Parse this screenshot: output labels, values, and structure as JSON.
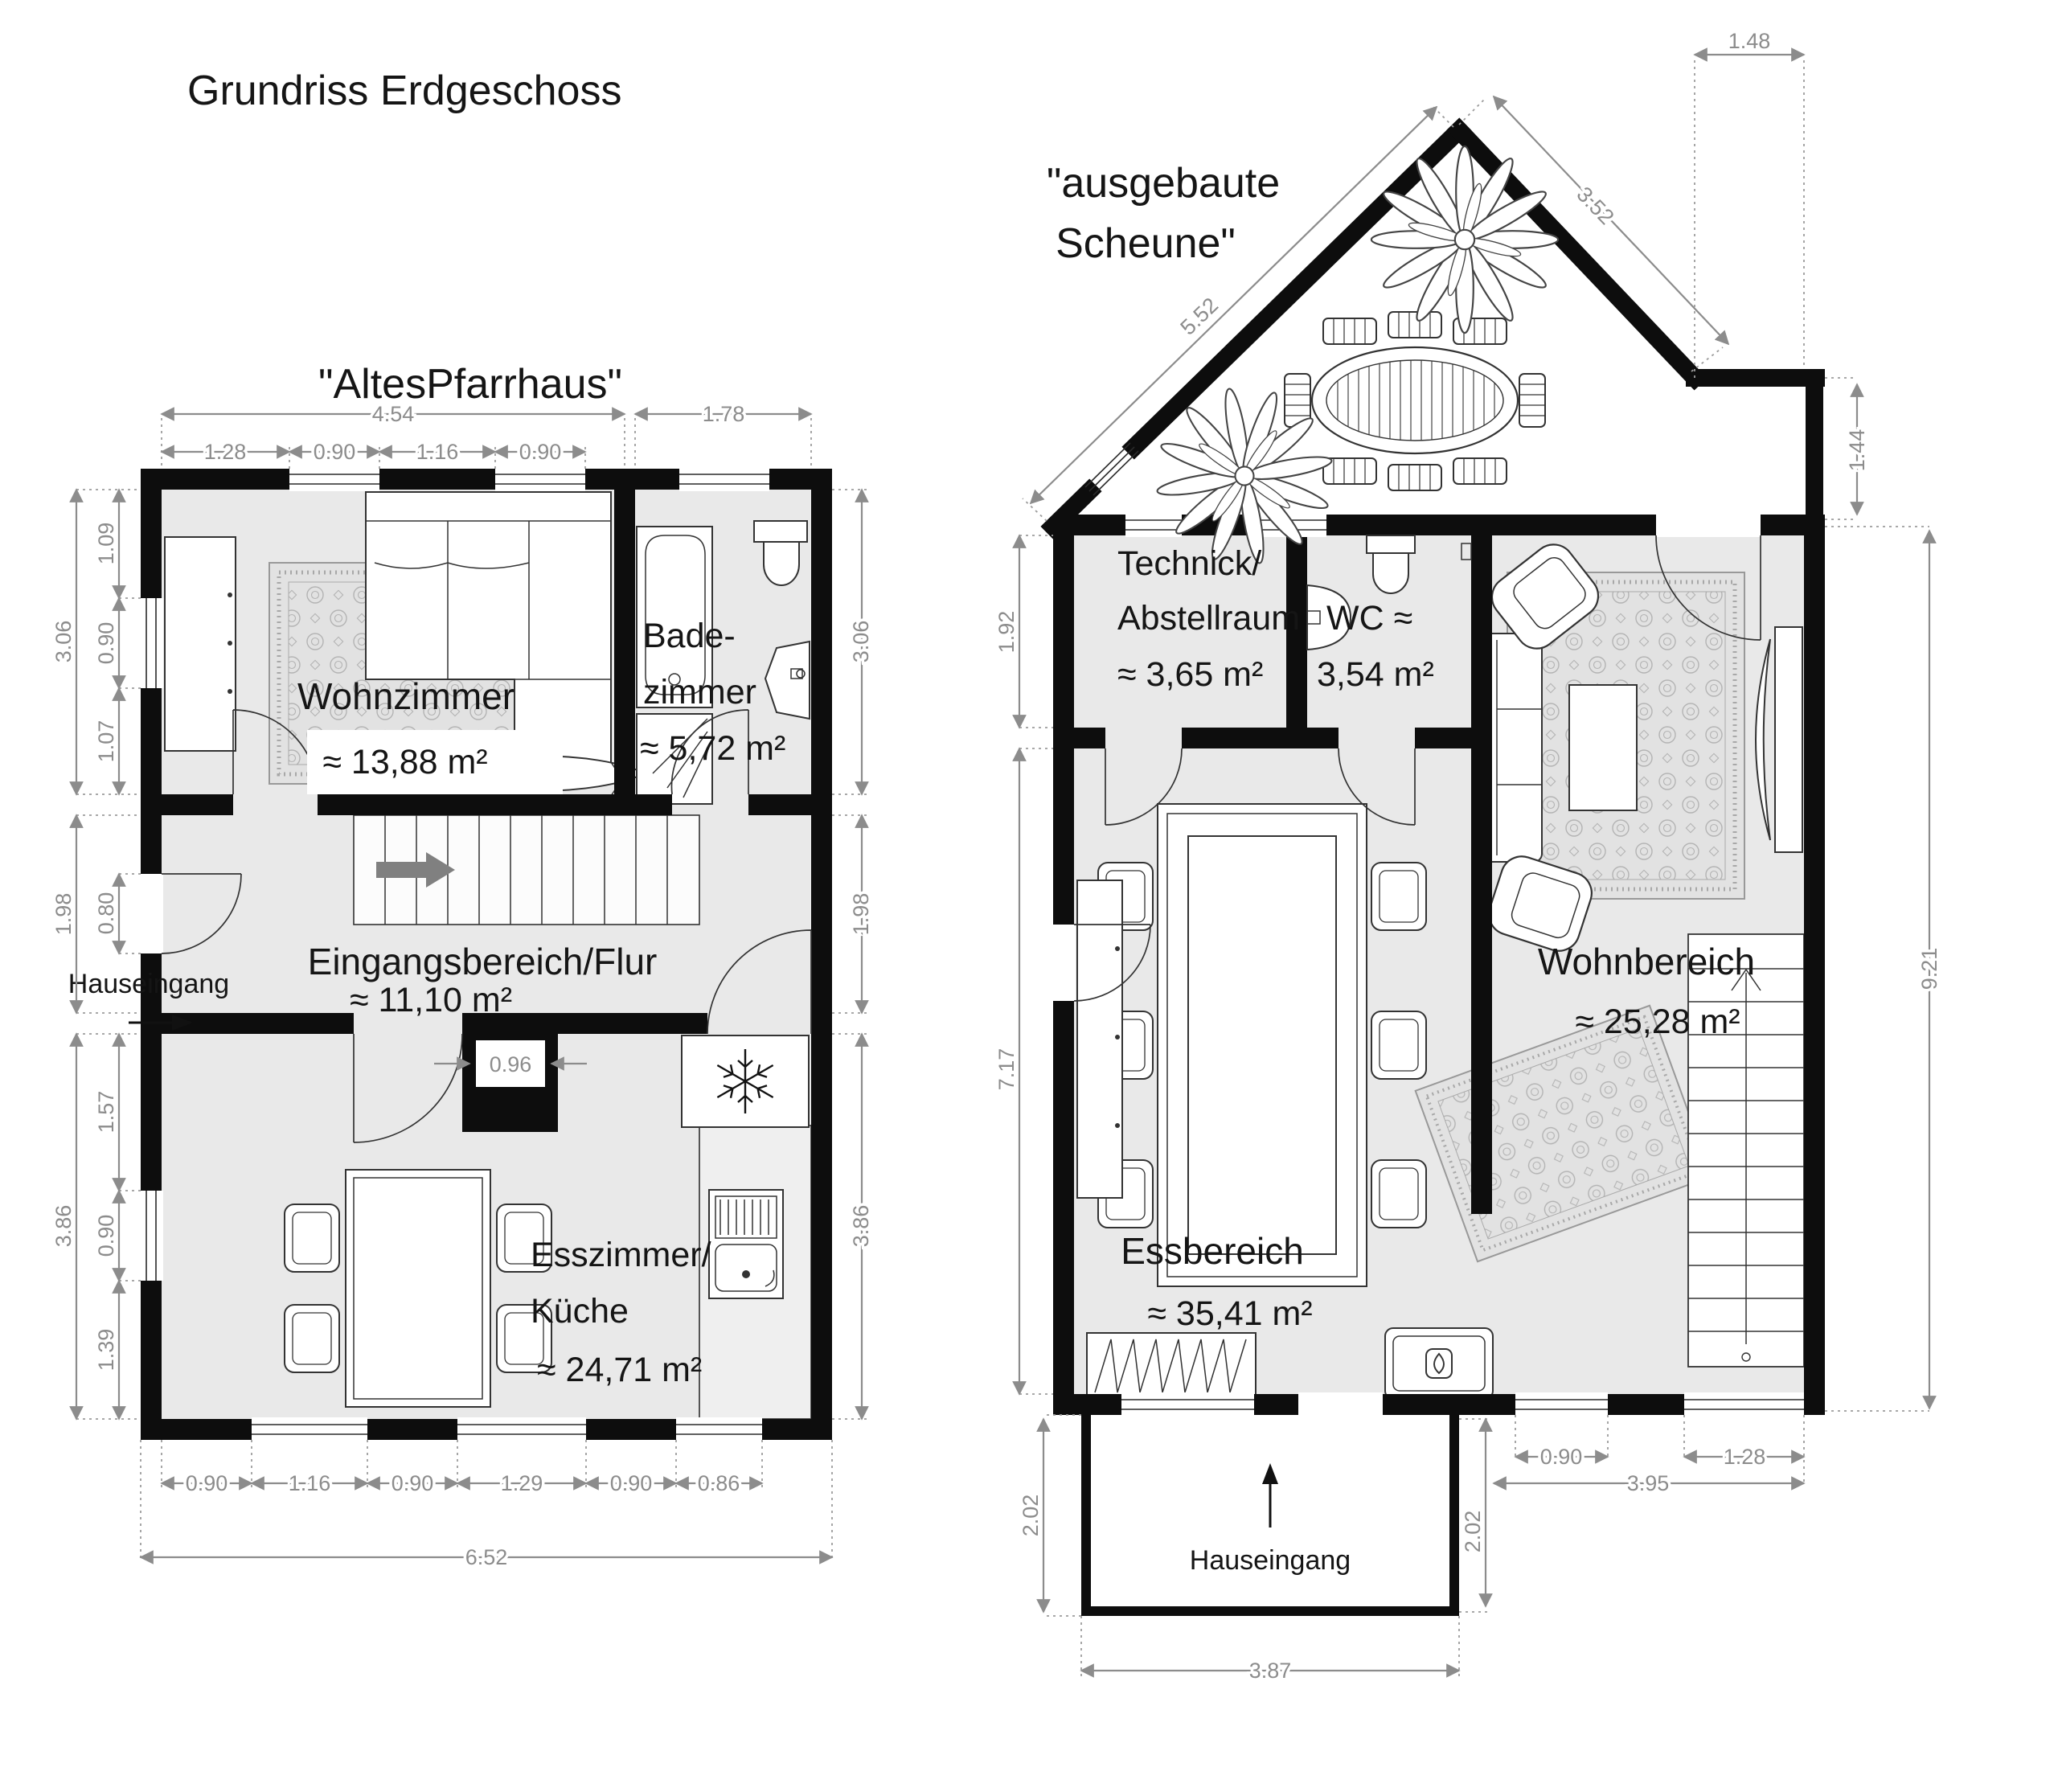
{
  "title": "Grundriss Erdgeschoss",
  "left_plan": {
    "name": "\"AltesPfarrhaus\"",
    "entrance": "Hauseingang",
    "rooms": {
      "wohnzimmer": {
        "label": "Wohnzimmer",
        "area": "≈ 13,88 m²"
      },
      "badezimmer": {
        "label1": "Bade-",
        "label2": "zimmer",
        "area": "≈ 5,72 m²"
      },
      "flur": {
        "label": "Eingangsbereich/Flur",
        "area": "≈ 11,10 m²"
      },
      "esszimmer": {
        "label1": "Esszimmer/",
        "label2": "Küche",
        "area": "≈ 24,71 m²"
      }
    },
    "dims": {
      "top_main": "4.54",
      "top_bath": "1.78",
      "top_sub": [
        "1.28",
        "0.90",
        "1.16",
        "0.90"
      ],
      "left_outer": [
        "3.06",
        "1.98",
        "3.86"
      ],
      "left_inner": [
        "1.09",
        "0.90",
        "1.07",
        "0.80",
        "1.57",
        "0.90",
        "1.39"
      ],
      "right_side": [
        "3.06",
        "1.98",
        "3.86"
      ],
      "bottom_sub": [
        "0.90",
        "1.16",
        "0.90",
        "1.29",
        "0.90",
        "0.86"
      ],
      "bottom_total": "6.52",
      "passage": "0.96"
    }
  },
  "right_plan": {
    "name_line1": "\"ausgebaute",
    "name_line2": "Scheune\"",
    "entrance": "Hauseingang",
    "rooms": {
      "technik": {
        "label1": "Technick/",
        "label2": "Abstellraum",
        "area": "≈ 3,65 m²"
      },
      "wc": {
        "label1": "WC ≈",
        "area": "3,54 m²"
      },
      "wohnbereich": {
        "label": "Wohnbereich",
        "area": "≈ 25,28 m²"
      },
      "essbereich": {
        "label": "Essbereich",
        "area": "≈ 35,41 m²"
      }
    },
    "dims": {
      "roof_left": "5.52",
      "roof_right": "3.52",
      "top_right": "1.48",
      "right_step": "1.44",
      "left_top": "1.92",
      "left_main": "7.17",
      "right_total": "9.21",
      "bottom_win1": "0.90",
      "bottom_win2": "1.28",
      "bottom_inner": "3.95",
      "porch_left": "2.02",
      "porch_right": "2.02",
      "porch_width": "3.87"
    }
  },
  "colors": {
    "floor": "#e9e9e9",
    "wall": "#0d0d0d",
    "dim": "#8c8c8c"
  }
}
